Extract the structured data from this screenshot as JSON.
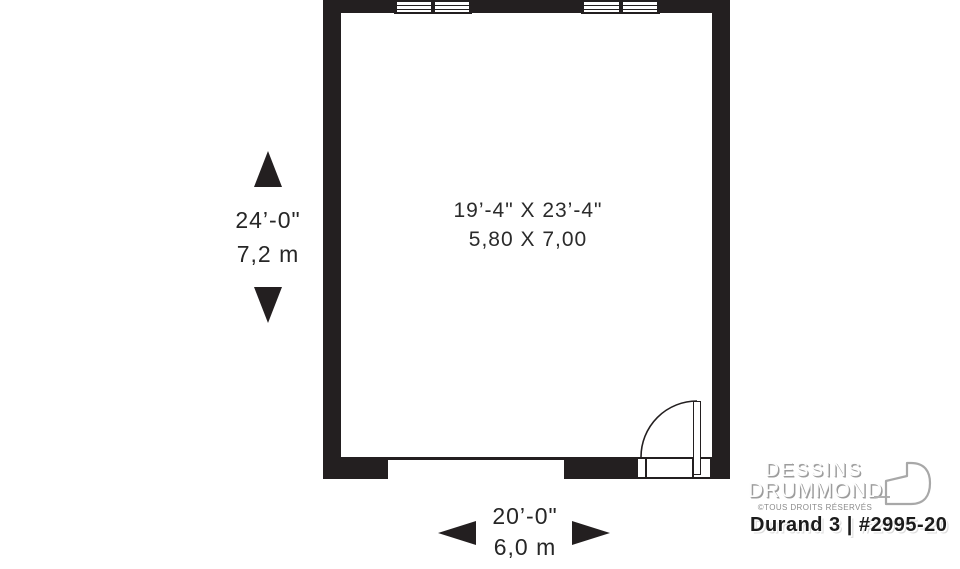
{
  "room": {
    "imperial": "19’-4\" X 23’-4\"",
    "metric": "5,80 X 7,00"
  },
  "dimensions": {
    "vertical": {
      "imperial": "24’-0\"",
      "metric": "7,2 m"
    },
    "horizontal": {
      "imperial": "20’-0\"",
      "metric": "6,0 m"
    }
  },
  "branding": {
    "name_line1": "DESSINS",
    "name_line2": "DRUMMOND",
    "rights": "©TOUS DROITS RÉSERVÉS",
    "plan_id": "Durand 3 | #2995-20"
  },
  "colors": {
    "wall": "#231f20",
    "dimension_text": "#262626",
    "logo_gray": "#9c9c9c",
    "rights_gray": "#8b8b8b"
  }
}
